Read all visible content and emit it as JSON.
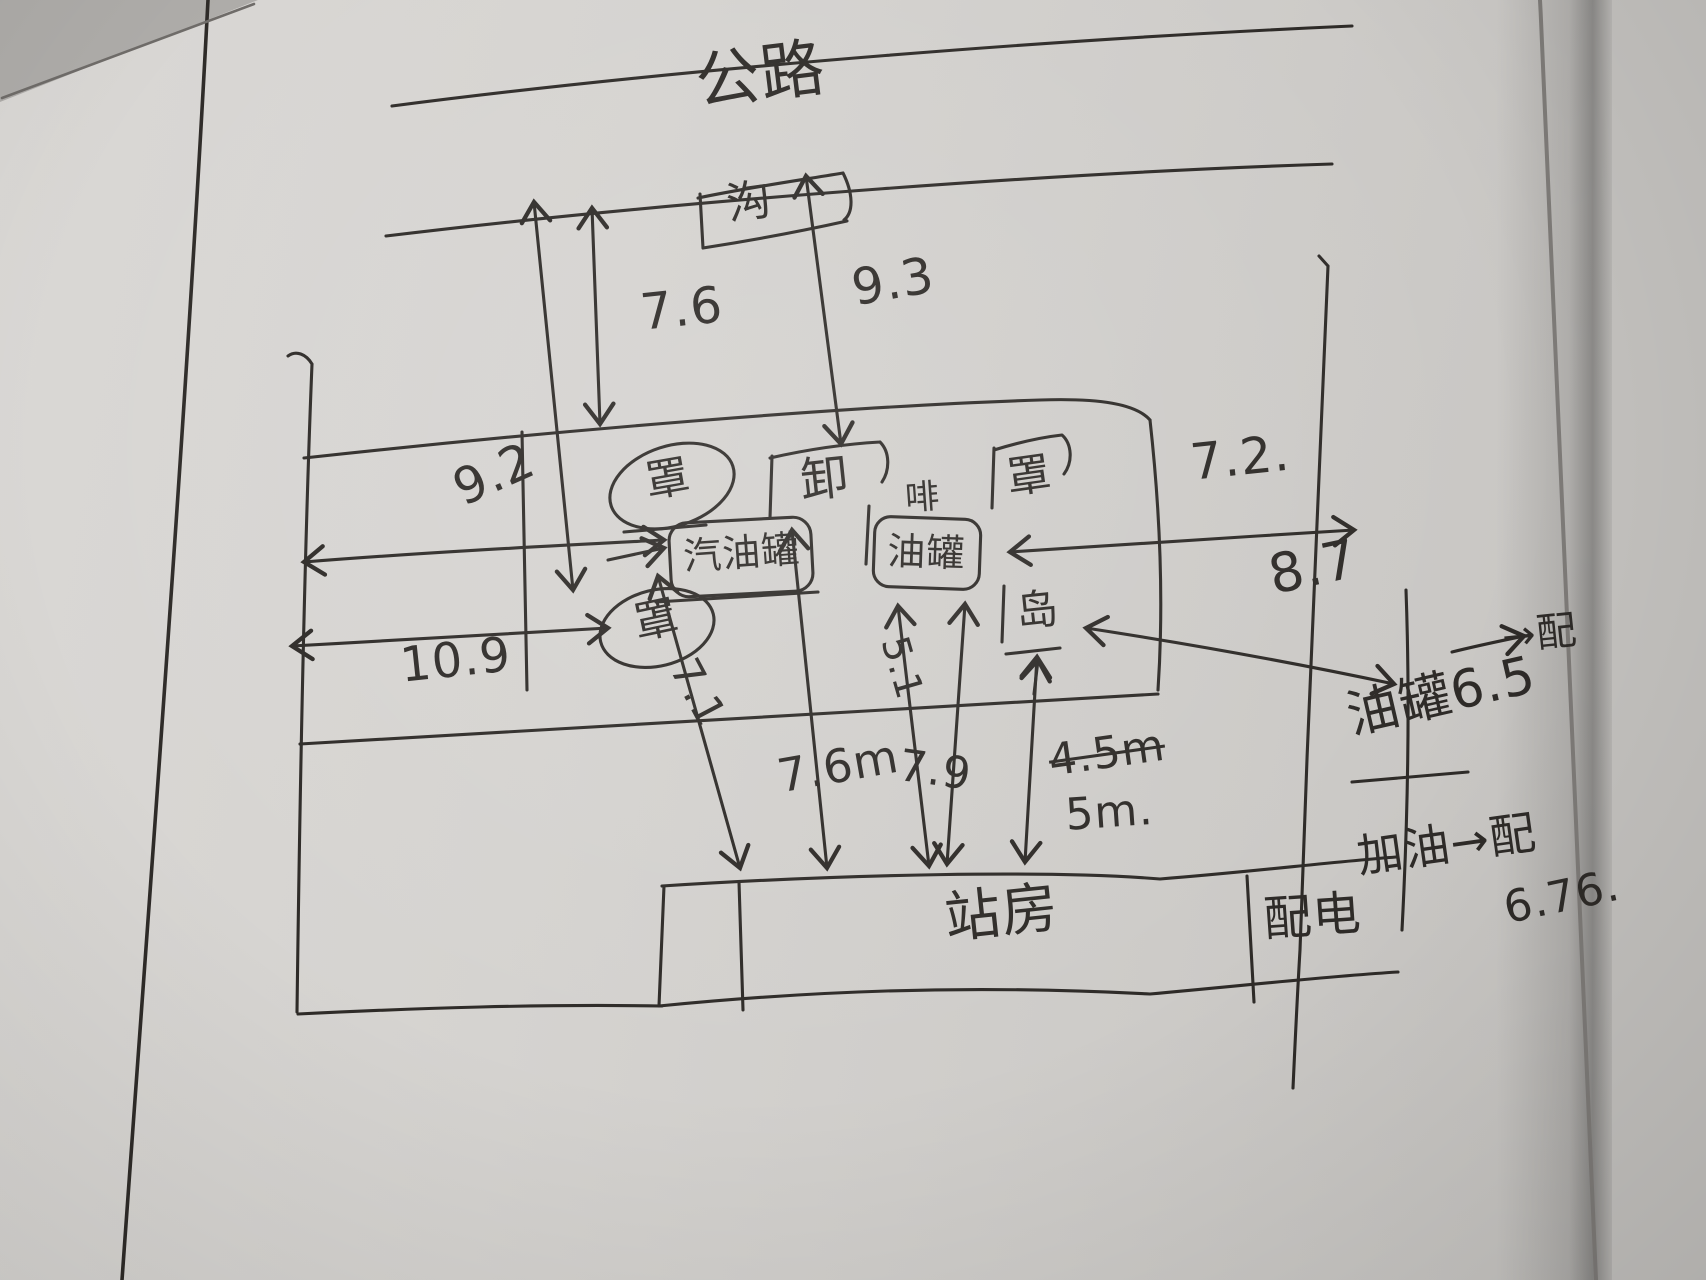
{
  "page": {
    "paper_color": "#d5d3d0",
    "ink_color": "#2e2b28",
    "media": "hand-drawn pen sketch on notebook page"
  },
  "diagram": {
    "road_label": "公路",
    "ditch_label": "沟",
    "unload_label": "卸",
    "vent_label": "啡",
    "marks": {
      "top_left": "罩",
      "top_right": "罩",
      "bottom_left": "罩",
      "bottom_right": "岛"
    },
    "tanks": {
      "gasoline_tank": "汽油罐",
      "oil_tank": "油罐"
    },
    "buildings": {
      "station_house": "站房",
      "power_room": "配电"
    },
    "measurements": {
      "road_to_canopy": "7.6",
      "road_to_unload": "9.3",
      "left_to_tank": "9.2",
      "left_to_mark": "10.9",
      "tank_to_right": "7.2.",
      "mark_to_right": "8.7",
      "tank_to_station_a": "7.1",
      "tank_to_station_b": "7.6m",
      "oiltank_to_line": "5.1",
      "oiltank_to_station": "7.9",
      "old_value": "4.5m",
      "new_value": "5m."
    },
    "margin_notes": {
      "arrow_note": "→配",
      "tank_note": "油罐6.5",
      "pump_note": "加油→配",
      "pump_value": "6.76."
    }
  }
}
